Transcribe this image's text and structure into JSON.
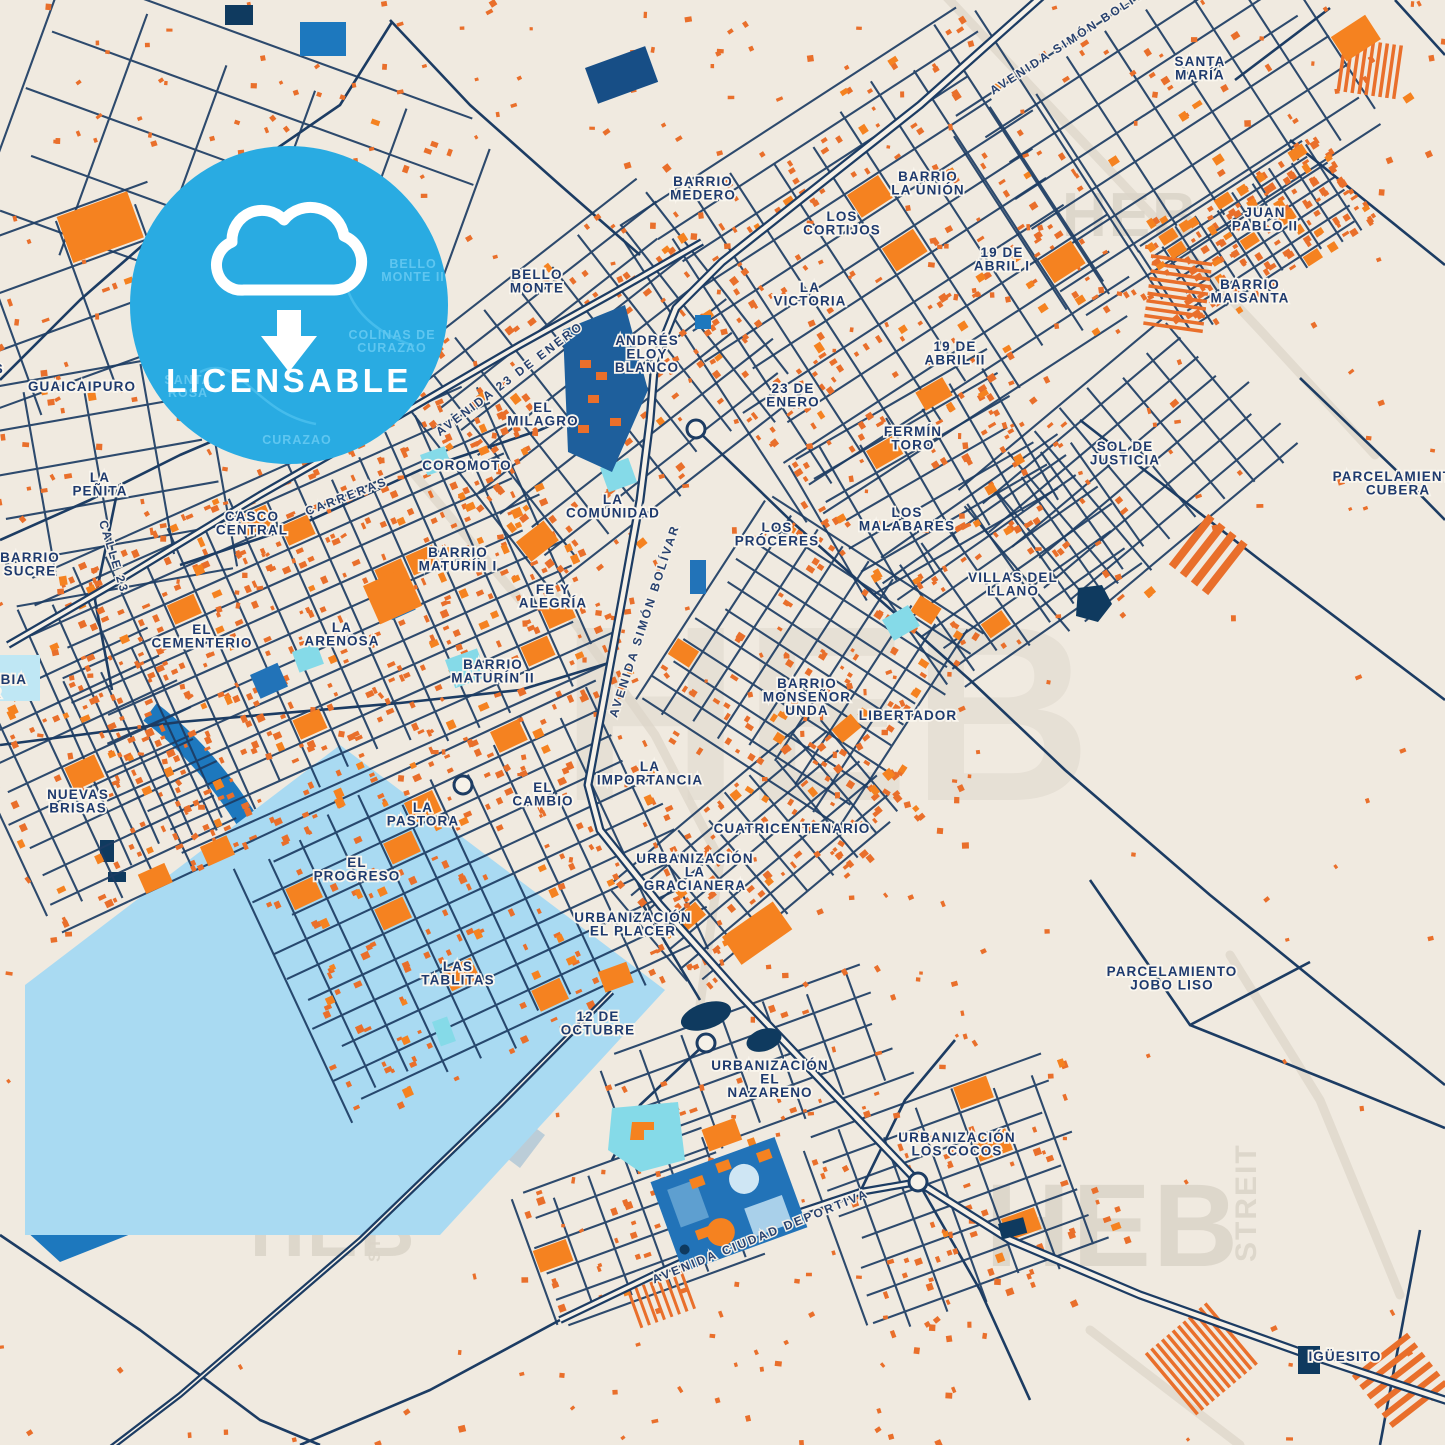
{
  "badge": {
    "label": "LICENSABLE",
    "icon": "cloud-download-icon",
    "color": "#29ABE2"
  },
  "colors": {
    "background": "#F0EAE0",
    "road": "#1C3C63",
    "road_fill": "#F6F1E8",
    "building_orange": "#E96F2B",
    "building_bright_orange": "#F58220",
    "water_light_blue": "#A9DAF2",
    "water_medium_blue": "#1D78BE",
    "pool_cyan": "#85DAE8",
    "institution_blue": "#1E5F9C",
    "dark_navy_building": "#0F3A5F",
    "label_navy": "#1E3A6E",
    "watermark_gray": "#DCD5C9",
    "badge_blue": "#29ABE2"
  },
  "watermarks": [
    {
      "text": "HEB",
      "x": 1062,
      "y": 236,
      "size": 62,
      "angle": 0
    },
    {
      "text": "HEB",
      "x": 560,
      "y": 800,
      "size": 250,
      "angle": 0,
      "opacity": 0.45
    },
    {
      "text": "HEB",
      "x": 985,
      "y": 1266,
      "size": 118,
      "angle": 0
    },
    {
      "text": "STREIT",
      "x": 1256,
      "y": 1262,
      "size": 30,
      "angle": -90
    },
    {
      "text": "HEB",
      "x": 250,
      "y": 1256,
      "size": 76,
      "angle": 0
    },
    {
      "text": "STREIT",
      "x": 380,
      "y": 1262,
      "size": 17,
      "angle": -90
    }
  ],
  "area_labels": [
    {
      "lines": [
        "GUAICAIPURO"
      ],
      "x": 82,
      "y": 391
    },
    {
      "lines": [
        "LA",
        "PEÑITA"
      ],
      "x": 100,
      "y": 482
    },
    {
      "lines": [
        "BARRIO",
        "SUCRE"
      ],
      "x": 30,
      "y": 562
    },
    {
      "lines": [
        "CASCO",
        "CENTRAL"
      ],
      "x": 252,
      "y": 521
    },
    {
      "lines": [
        "COROMOTO"
      ],
      "x": 467,
      "y": 470
    },
    {
      "lines": [
        "BELLO",
        "MONTE"
      ],
      "x": 537,
      "y": 279
    },
    {
      "lines": [
        "ANDRÉS",
        "ELOY",
        "BLANCO"
      ],
      "x": 647,
      "y": 345
    },
    {
      "lines": [
        "EL",
        "MILAGRO"
      ],
      "x": 543,
      "y": 412
    },
    {
      "lines": [
        "LA",
        "COMUNIDAD"
      ],
      "x": 613,
      "y": 504
    },
    {
      "lines": [
        "BARRIO",
        "MEDERO"
      ],
      "x": 703,
      "y": 186
    },
    {
      "lines": [
        "LOS",
        "CORTIJOS"
      ],
      "x": 842,
      "y": 221
    },
    {
      "lines": [
        "BARRIO",
        "LA UNIÓN"
      ],
      "x": 928,
      "y": 181
    },
    {
      "lines": [
        "19 DE",
        "ABRIL I"
      ],
      "x": 1002,
      "y": 257
    },
    {
      "lines": [
        "LA",
        "VICTORIA"
      ],
      "x": 810,
      "y": 292
    },
    {
      "lines": [
        "19 DE",
        "ABRIL II"
      ],
      "x": 955,
      "y": 351
    },
    {
      "lines": [
        "23 DE",
        "ENERO"
      ],
      "x": 793,
      "y": 393
    },
    {
      "lines": [
        "SANTA",
        "MARÍA"
      ],
      "x": 1200,
      "y": 66
    },
    {
      "lines": [
        "JUAN",
        "PABLO II"
      ],
      "x": 1265,
      "y": 217
    },
    {
      "lines": [
        "BARRIO",
        "MAISANTA"
      ],
      "x": 1250,
      "y": 289
    },
    {
      "lines": [
        "PARCELAMIENTO",
        "CUBERA"
      ],
      "x": 1398,
      "y": 481
    },
    {
      "lines": [
        "FERMÍN",
        "TORO"
      ],
      "x": 913,
      "y": 436
    },
    {
      "lines": [
        "SOL DE",
        "JUSTICIA"
      ],
      "x": 1125,
      "y": 451
    },
    {
      "lines": [
        "LOS",
        "MALABARES"
      ],
      "x": 907,
      "y": 517
    },
    {
      "lines": [
        "VILLAS DEL",
        "LLANO"
      ],
      "x": 1013,
      "y": 582
    },
    {
      "lines": [
        "BARRIO",
        "MATURÍN I"
      ],
      "x": 458,
      "y": 557
    },
    {
      "lines": [
        "FE Y",
        "ALEGRÍA"
      ],
      "x": 553,
      "y": 594
    },
    {
      "lines": [
        "EL",
        "CEMENTERIO"
      ],
      "x": 202,
      "y": 634
    },
    {
      "lines": [
        "LA",
        "ARENOSA"
      ],
      "x": 342,
      "y": 632
    },
    {
      "lines": [
        "BARRIO",
        "MATURÍN II"
      ],
      "x": 493,
      "y": 669
    },
    {
      "lines": [
        "LOS",
        "PRÓCERES"
      ],
      "x": 777,
      "y": 532
    },
    {
      "lines": [
        "BARRIO",
        "MONSEÑOR",
        "UNDA"
      ],
      "x": 807,
      "y": 688
    },
    {
      "lines": [
        "LIBERTADOR"
      ],
      "x": 908,
      "y": 720
    },
    {
      "lines": [
        "LA",
        "IMPORTANCIA"
      ],
      "x": 650,
      "y": 771
    },
    {
      "lines": [
        "EL",
        "CAMBIO"
      ],
      "x": 543,
      "y": 792
    },
    {
      "lines": [
        "LA",
        "PASTORA"
      ],
      "x": 423,
      "y": 812
    },
    {
      "lines": [
        "EL",
        "PROGRESO"
      ],
      "x": 357,
      "y": 867
    },
    {
      "lines": [
        "NUEVAS",
        "BRISAS"
      ],
      "x": 78,
      "y": 799
    },
    {
      "lines": [
        "COLOMBIA",
        "SUR"
      ],
      "x": -14,
      "y": 684
    },
    {
      "lines": [
        "LOS",
        "GODOS"
      ],
      "x": -24,
      "y": 360
    },
    {
      "lines": [
        "URBANIZACIÓN",
        "LA",
        "GRACIANERA"
      ],
      "x": 695,
      "y": 863
    },
    {
      "lines": [
        "CUATRICENTENARIO"
      ],
      "x": 792,
      "y": 833
    },
    {
      "lines": [
        "URBANIZACIÓN",
        "EL PLACER"
      ],
      "x": 633,
      "y": 922
    },
    {
      "lines": [
        "LAS",
        "TABLITAS"
      ],
      "x": 458,
      "y": 971
    },
    {
      "lines": [
        "12 DE",
        "OCTUBRE"
      ],
      "x": 598,
      "y": 1021
    },
    {
      "lines": [
        "URBANIZACIÓN",
        "EL",
        "NAZARENO"
      ],
      "x": 770,
      "y": 1070
    },
    {
      "lines": [
        "URBANIZACIÓN",
        "LOS COCOS"
      ],
      "x": 957,
      "y": 1142
    },
    {
      "lines": [
        "PARCELAMIENTO",
        "JOBO LISO"
      ],
      "x": 1172,
      "y": 976
    },
    {
      "lines": [
        "IGÜESITO"
      ],
      "x": 1345,
      "y": 1361
    }
  ],
  "street_labels": [
    {
      "text": "AVENIDA SIMÓN BOLÍVAR",
      "x": 1078,
      "y": 40,
      "angle": -33
    },
    {
      "text": "AVENIDA 23 DE ENERO",
      "x": 512,
      "y": 382,
      "angle": -37
    },
    {
      "text": "CARRERAS",
      "x": 348,
      "y": 500,
      "angle": -21
    },
    {
      "text": "CALLE 23",
      "x": 110,
      "y": 558,
      "angle": 73
    },
    {
      "text": "AVENIDA SIMÓN BOLÍVAR",
      "x": 648,
      "y": 622,
      "angle": -72
    },
    {
      "text": "AVENIDA CIUDAD DEPORTIVA",
      "x": 762,
      "y": 1240,
      "angle": -22
    }
  ],
  "badge_ghost_labels": [
    {
      "lines": [
        "BELLO",
        "MONTE II"
      ],
      "x": 413,
      "y": 268
    },
    {
      "lines": [
        "COLINAS DE",
        "CURAZAO"
      ],
      "x": 392,
      "y": 339
    },
    {
      "lines": [
        "SANTA",
        "ROSA"
      ],
      "x": 188,
      "y": 384
    },
    {
      "lines": [
        "CURAZAO"
      ],
      "x": 297,
      "y": 444
    }
  ]
}
